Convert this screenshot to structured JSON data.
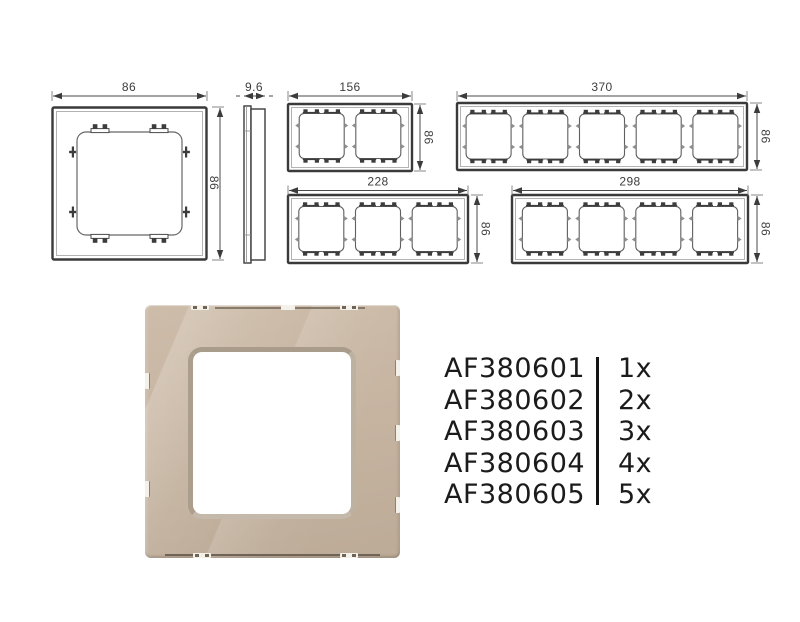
{
  "drawings": {
    "line_color": "#3a3a3a",
    "dim_text_color": "#3d3d3d",
    "single_front": {
      "width_label": "86",
      "height_label": "86"
    },
    "side_profile": {
      "depth_label": "9.6"
    },
    "two_gang": {
      "width_label": "156",
      "height_label": "86"
    },
    "five_gang": {
      "width_label": "370",
      "height_label": "86"
    },
    "three_gang": {
      "width_label": "228",
      "height_label": "86"
    },
    "four_gang": {
      "width_label": "298",
      "height_label": "86"
    }
  },
  "product_photo": {
    "glass_color": "#c6b4a1",
    "bevel_color": "#b2a593"
  },
  "product_list": {
    "items": [
      {
        "code": "AF380601",
        "qty": "1x"
      },
      {
        "code": "AF380602",
        "qty": "2x"
      },
      {
        "code": "AF380603",
        "qty": "3x"
      },
      {
        "code": "AF380604",
        "qty": "4x"
      },
      {
        "code": "AF380605",
        "qty": "5x"
      }
    ]
  }
}
